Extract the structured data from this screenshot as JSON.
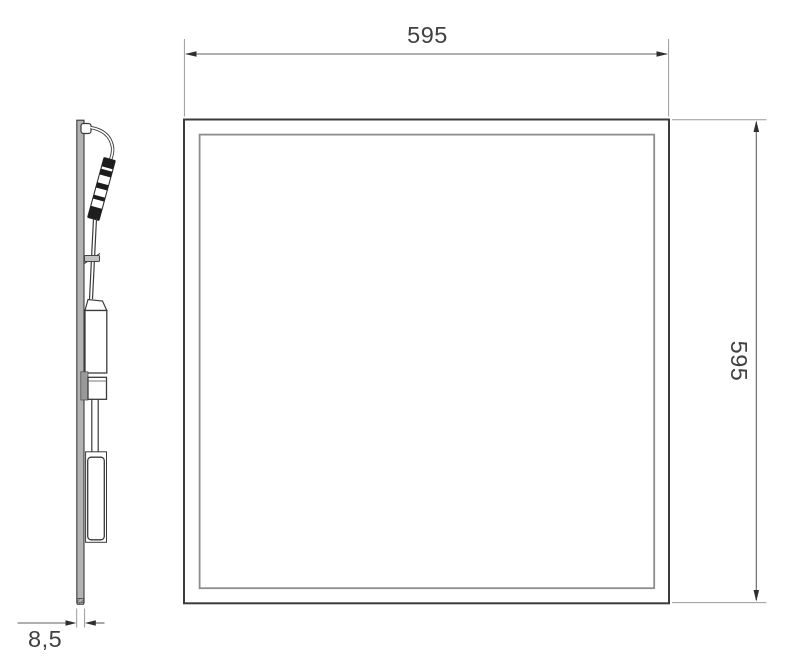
{
  "drawing": {
    "dimension_labels": {
      "width": "595",
      "height": "595",
      "thickness": "8,5"
    },
    "colors": {
      "background": "#ffffff",
      "line_dark": "#3b3b3b",
      "inner_frame": "#8d8d8d",
      "ext_line": "#9a9a9a",
      "dim_line": "#606060",
      "arrow": "#2f2f2f",
      "text": "#414042",
      "panel_fill": "#b3b3b3",
      "bracket_fill": "#999999",
      "clip_fill": "#c2c2c2"
    }
  }
}
